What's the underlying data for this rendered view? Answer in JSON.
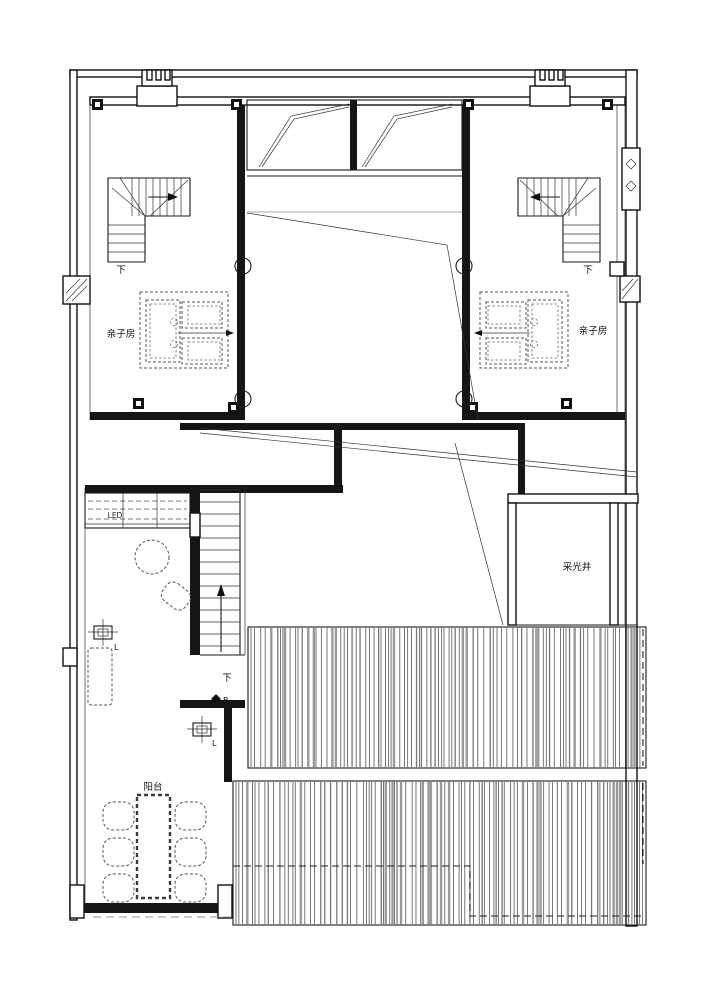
{
  "drawing": {
    "type": "architectural-floor-plan",
    "canvas": {
      "width": 707,
      "height": 1000
    }
  },
  "colors": {
    "line": "#1a1a1a",
    "wall": "#111111",
    "hatch_dark": "#3d3d3d",
    "hatch_mid": "#777777",
    "hatch_light": "#9a9a9a",
    "dashed": "#555555",
    "gray_line": "#a8a8a8",
    "background": "#ffffff"
  },
  "labels": {
    "room_left": "亲子房",
    "room_right": "亲子房",
    "light_well": "采光井",
    "balcony": "阳台",
    "led": "LED",
    "down_left": "下",
    "down_right": "下",
    "down_main": "下",
    "marker_b": "B",
    "light_fixture_1": "L",
    "light_fixture_2": "L"
  },
  "icons": {
    "diamond_marker": "diamond-marker-icon",
    "window_diamond": "window-diamond-icon",
    "direction_arrows": "direction-arrow-icon"
  }
}
